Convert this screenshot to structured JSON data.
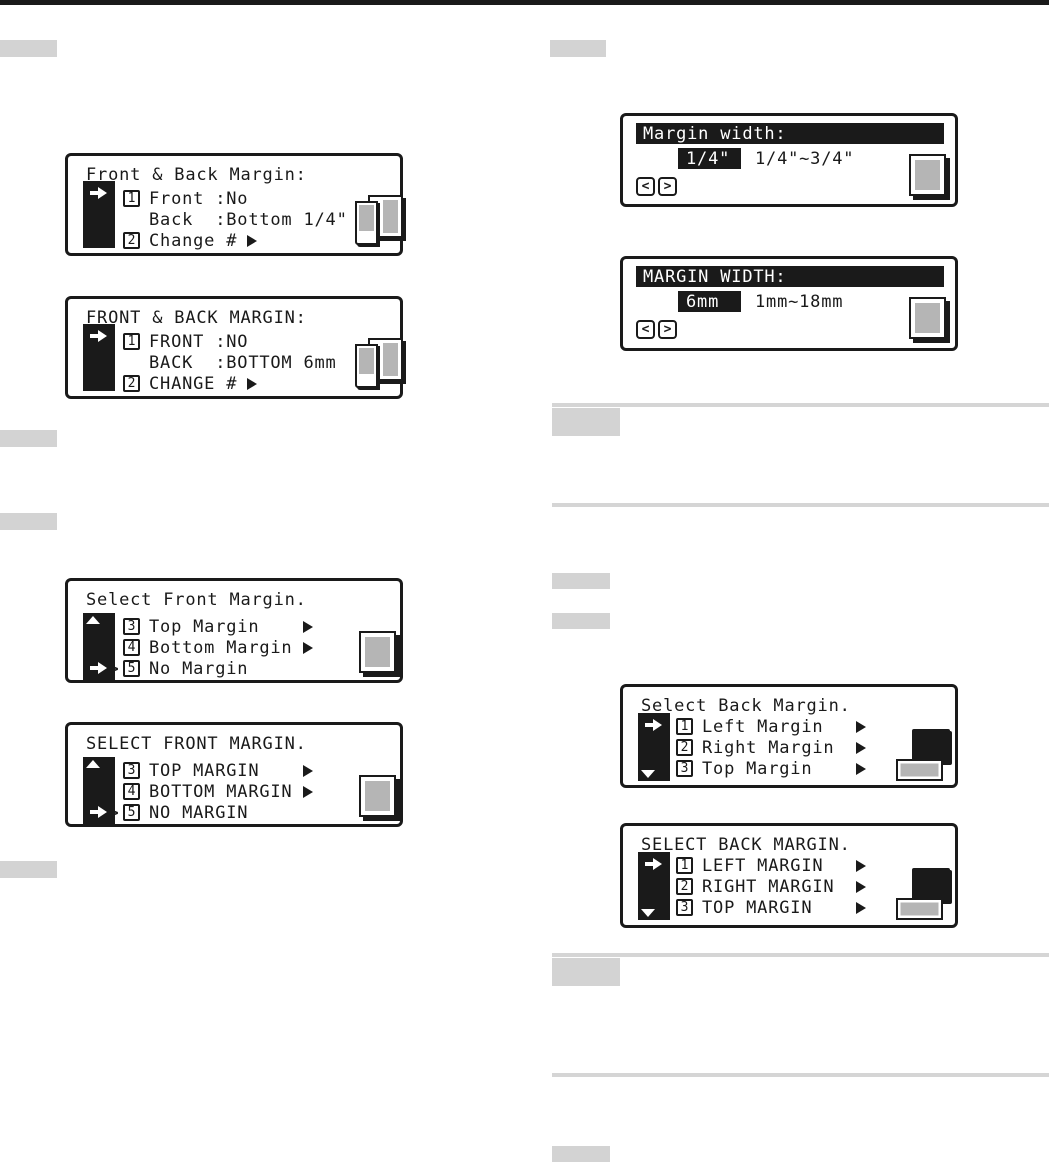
{
  "panels": {
    "fb_inch": {
      "title": "Front & Back Margin:",
      "line1_num": "1",
      "line1": "Front :No",
      "line2": "Back  :Bottom 1/4\"",
      "line3_num": "2",
      "line3": "Change #"
    },
    "fb_mm": {
      "title": "FRONT & BACK MARGIN:",
      "line1_num": "1",
      "line1": "FRONT :NO",
      "line2": "BACK  :BOTTOM 6mm",
      "line3_num": "2",
      "line3": "CHANGE #"
    },
    "front_inch": {
      "title": "Select Front Margin.",
      "line1_num": "3",
      "line1": "Top Margin",
      "line2_num": "4",
      "line2": "Bottom Margin",
      "line3_prefix": ">",
      "line3_num": "5",
      "line3": "No Margin"
    },
    "front_mm": {
      "title": "SELECT FRONT MARGIN.",
      "line1_num": "3",
      "line1": "TOP MARGIN",
      "line2_num": "4",
      "line2": "BOTTOM MARGIN",
      "line3_prefix": ">",
      "line3_num": "5",
      "line3": "NO MARGIN"
    },
    "width_inch": {
      "title": "Margin width:",
      "value": "1/4\"",
      "range": "1/4\"~3/4\"",
      "prev": "<",
      "next": ">"
    },
    "width_mm": {
      "title": "MARGIN WIDTH:",
      "value": "6mm",
      "range": "1mm~18mm",
      "prev": "<",
      "next": ">"
    },
    "back_inch": {
      "title": "Select Back Margin.",
      "line1_num": "1",
      "line1": "Left Margin",
      "line2_num": "2",
      "line2": "Right Margin",
      "line3_num": "3",
      "line3": "Top Margin"
    },
    "back_mm": {
      "title": "SELECT BACK MARGIN.",
      "line1_num": "1",
      "line1": "LEFT MARGIN",
      "line2_num": "2",
      "line2": "RIGHT MARGIN",
      "line3_num": "3",
      "line3": "TOP MARGIN"
    }
  },
  "colors": {
    "ink": "#1a1a1a",
    "lcd_gray": "#b5b5b5",
    "placeholder_gray": "#d3d3d3"
  }
}
